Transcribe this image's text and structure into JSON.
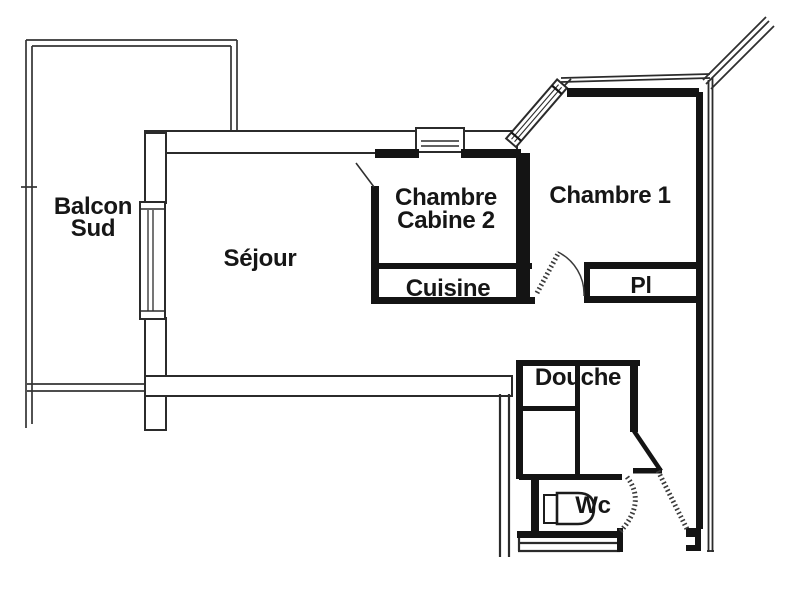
{
  "plan": {
    "type": "apartment-floor-plan",
    "rooms": {
      "balcon": {
        "line1": "Balcon",
        "line2": "Sud"
      },
      "sejour": {
        "label": "Séjour"
      },
      "chambre_cabine": {
        "line1": "Chambre",
        "line2": "Cabine 2"
      },
      "chambre1": {
        "label": "Chambre 1"
      },
      "cuisine": {
        "label": "Cuisine"
      },
      "placard": {
        "label": "Pl"
      },
      "douche": {
        "label": "Douche"
      },
      "wc": {
        "label": "Wc"
      }
    },
    "colors": {
      "background": "#ffffff",
      "wall_heavy": "#141414",
      "line_thin": "#2f2f2f",
      "label_text": "#161616"
    }
  }
}
